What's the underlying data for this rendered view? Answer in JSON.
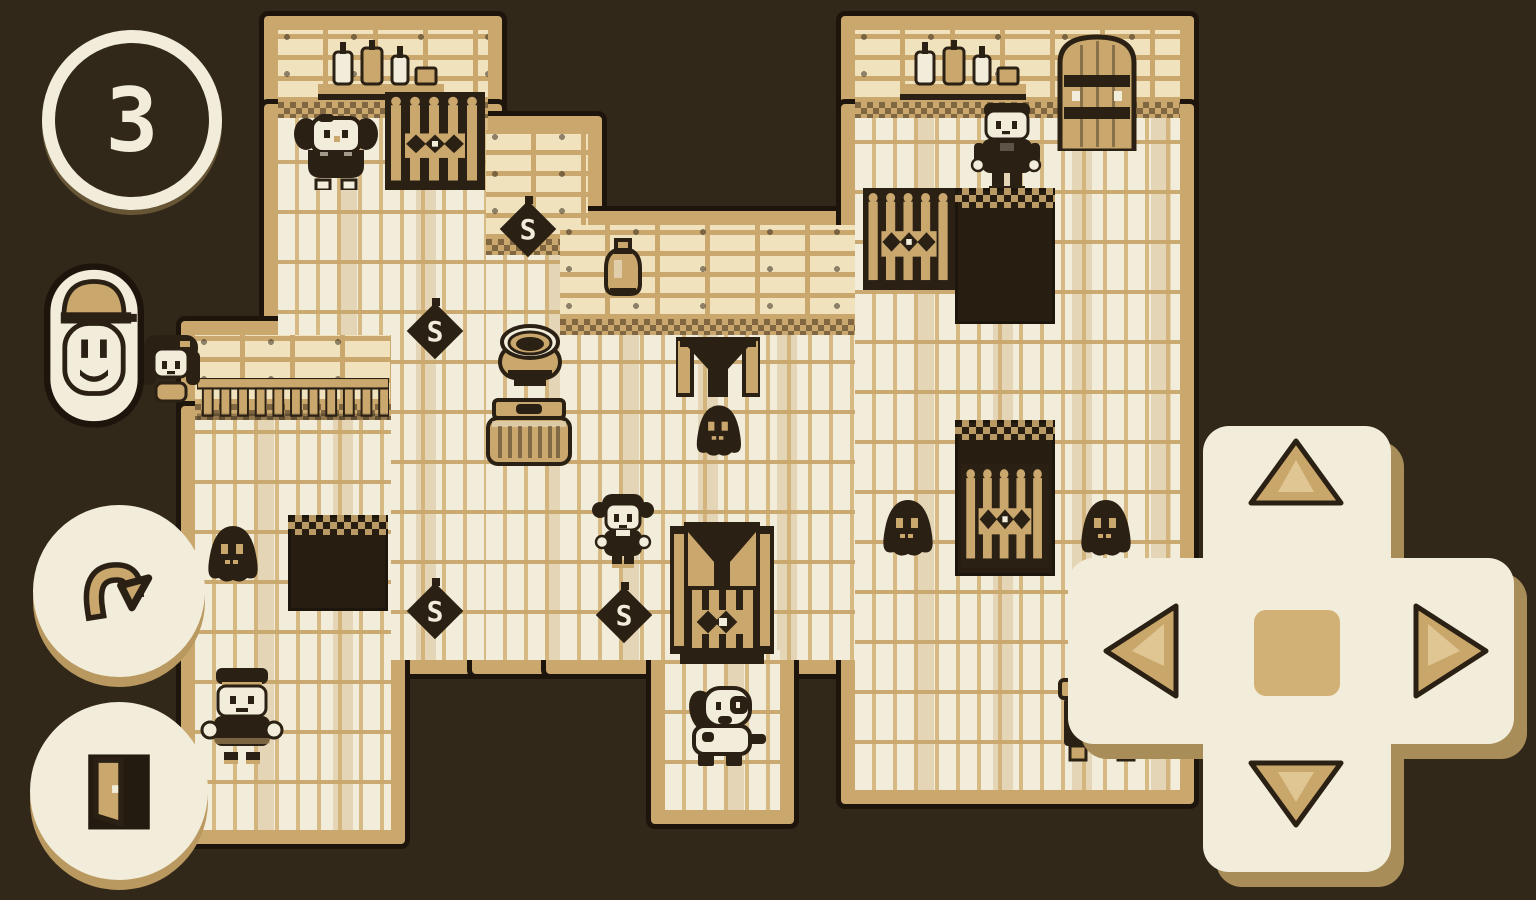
{
  "palette": {
    "bg": "#32281a",
    "cream": "#f2ecda",
    "tan": "#c9a76d",
    "tan_deep": "#b9995f",
    "ink": "#2b2014",
    "pit": "#271e11",
    "plank_seam": "#d7ba83",
    "wall_bg": "#efe2bd",
    "shadow": "#a98d58",
    "arrow": "#c9a76b",
    "arrow_light": "#e0c693",
    "dpad_center": "#d2b176"
  },
  "hud": {
    "moves_counter": {
      "value": "3",
      "icon": "counter-ring-icon"
    },
    "portrait": {
      "icon": "capped-man-portrait-icon",
      "description": "smiling man wearing a flat cap"
    },
    "undo_button": {
      "icon": "undo-arrow-icon"
    },
    "exit_button": {
      "icon": "open-door-icon"
    }
  },
  "dpad": {
    "icon": "dpad-cross",
    "buttons": [
      {
        "direction": "up",
        "icon": "triangle-up-icon"
      },
      {
        "direction": "down",
        "icon": "triangle-down-icon"
      },
      {
        "direction": "left",
        "icon": "triangle-left-icon"
      },
      {
        "direction": "right",
        "icon": "triangle-right-icon"
      },
      {
        "direction": "center",
        "icon": "square-center-icon"
      }
    ]
  },
  "map": {
    "switch_label": "S",
    "surfaces": [
      {
        "kind": "wall",
        "x": 278,
        "y": 30,
        "w": 210,
        "h": 88
      },
      {
        "kind": "floor",
        "x": 278,
        "y": 118,
        "w": 210,
        "h": 542
      },
      {
        "kind": "wall",
        "x": 195,
        "y": 335,
        "w": 196,
        "h": 85
      },
      {
        "kind": "floor",
        "x": 195,
        "y": 420,
        "w": 196,
        "h": 410
      },
      {
        "kind": "wall",
        "x": 486,
        "y": 130,
        "w": 102,
        "h": 125
      },
      {
        "kind": "floor",
        "x": 486,
        "y": 255,
        "w": 102,
        "h": 405
      },
      {
        "kind": "wall",
        "x": 560,
        "y": 225,
        "w": 298,
        "h": 110
      },
      {
        "kind": "floor",
        "x": 560,
        "y": 335,
        "w": 298,
        "h": 325
      },
      {
        "kind": "floor",
        "x": 665,
        "y": 650,
        "w": 115,
        "h": 160
      },
      {
        "kind": "wall",
        "x": 855,
        "y": 30,
        "w": 325,
        "h": 88
      },
      {
        "kind": "floor",
        "x": 855,
        "y": 118,
        "w": 325,
        "h": 672
      }
    ],
    "entities": [
      {
        "type": "shelf-bottles",
        "x": 316,
        "y": 38,
        "w": 130,
        "h": 68
      },
      {
        "type": "portcullis",
        "x": 385,
        "y": 92,
        "w": 100,
        "h": 98
      },
      {
        "type": "elder",
        "x": 292,
        "y": 112,
        "w": 88,
        "h": 78
      },
      {
        "type": "fence",
        "x": 197,
        "y": 378,
        "w": 192,
        "h": 44
      },
      {
        "type": "s-diamond",
        "x": 497,
        "y": 196,
        "w": 62,
        "h": 64
      },
      {
        "type": "s-diamond",
        "x": 404,
        "y": 298,
        "w": 62,
        "h": 64
      },
      {
        "type": "jar",
        "x": 600,
        "y": 236,
        "w": 46,
        "h": 60
      },
      {
        "type": "pot",
        "x": 490,
        "y": 318,
        "w": 80,
        "h": 82
      },
      {
        "type": "basket",
        "x": 486,
        "y": 398,
        "w": 86,
        "h": 72
      },
      {
        "type": "funnel",
        "x": 676,
        "y": 337,
        "w": 84,
        "h": 80
      },
      {
        "type": "ghost",
        "x": 692,
        "y": 400,
        "w": 52,
        "h": 56
      },
      {
        "type": "woman",
        "x": 132,
        "y": 333,
        "w": 78,
        "h": 88
      },
      {
        "type": "pit",
        "x": 288,
        "y": 515,
        "w": 100,
        "h": 96
      },
      {
        "type": "ghost",
        "x": 203,
        "y": 520,
        "w": 58,
        "h": 62
      },
      {
        "type": "s-diamond",
        "x": 404,
        "y": 578,
        "w": 62,
        "h": 64
      },
      {
        "type": "s-diamond",
        "x": 593,
        "y": 582,
        "w": 62,
        "h": 64
      },
      {
        "type": "girl",
        "x": 588,
        "y": 492,
        "w": 70,
        "h": 80
      },
      {
        "type": "gate-tower",
        "x": 670,
        "y": 522,
        "w": 104,
        "h": 142
      },
      {
        "type": "dog",
        "x": 678,
        "y": 678,
        "w": 92,
        "h": 108
      },
      {
        "type": "bellboy",
        "x": 196,
        "y": 666,
        "w": 92,
        "h": 102
      },
      {
        "type": "shelf-bottles",
        "x": 898,
        "y": 38,
        "w": 130,
        "h": 68
      },
      {
        "type": "big-door",
        "x": 1056,
        "y": 33,
        "w": 82,
        "h": 118
      },
      {
        "type": "soldier",
        "x": 966,
        "y": 103,
        "w": 82,
        "h": 96
      },
      {
        "type": "portcullis",
        "x": 863,
        "y": 188,
        "w": 92,
        "h": 102
      },
      {
        "type": "pit",
        "x": 955,
        "y": 188,
        "w": 100,
        "h": 136
      },
      {
        "type": "pit-gate",
        "x": 955,
        "y": 420,
        "w": 100,
        "h": 156
      },
      {
        "type": "ghost",
        "x": 878,
        "y": 494,
        "w": 58,
        "h": 62
      },
      {
        "type": "ghost",
        "x": 1076,
        "y": 494,
        "w": 58,
        "h": 62
      },
      {
        "type": "furniture",
        "x": 1058,
        "y": 676,
        "w": 88,
        "h": 88
      }
    ]
  }
}
